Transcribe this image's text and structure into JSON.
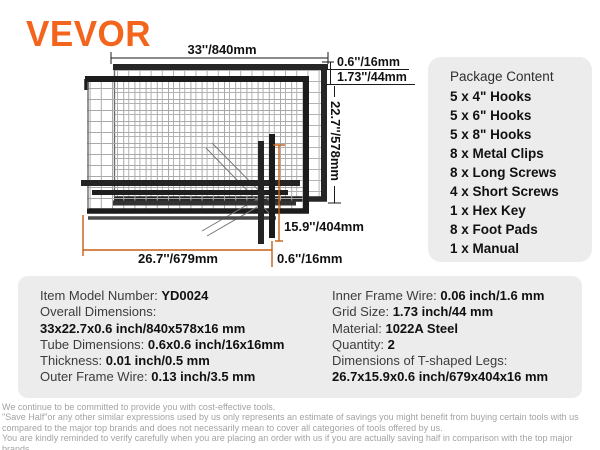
{
  "brand": {
    "name": "VEVOR"
  },
  "colors": {
    "brand_orange": "#F3641C",
    "dimension_orange": "#C85E15",
    "panel_background": "#ececec",
    "frame_black": "#1c1c1c"
  },
  "diagram": {
    "dims": {
      "overall_width": "33''/840mm",
      "frame_tube": "0.6''/16mm",
      "grid_size": "1.73''/44mm",
      "overall_height": "22.7''/578mm",
      "leg_height": "15.9''/404mm",
      "leg_length": "26.7''/679mm",
      "leg_tube": "0.6''/16mm"
    }
  },
  "package": {
    "title": "Package Content",
    "items": [
      "5 x 4\" Hooks",
      "5 x 6\" Hooks",
      "5 x 8\" Hooks",
      "8 x Metal Clips",
      "8 x Long Screws",
      "4 x Short Screws",
      "1 x Hex Key",
      "8 x Foot Pads",
      "1 x Manual"
    ]
  },
  "specs": {
    "left": [
      {
        "label": "Item Model Number: ",
        "value": "YD0024"
      },
      {
        "label": "Overall Dimensions:",
        "value": ""
      },
      {
        "label": "",
        "value": "33x22.7x0.6 inch/840x578x16 mm"
      },
      {
        "label": "Tube Dimensions: ",
        "value": "0.6x0.6 inch/16x16mm"
      },
      {
        "label": "Thickness: ",
        "value": "0.01 inch/0.5 mm"
      },
      {
        "label": "Outer Frame Wire: ",
        "value": "0.13 inch/3.5 mm"
      }
    ],
    "right": [
      {
        "label": "Inner Frame Wire: ",
        "value": "0.06 inch/1.6 mm"
      },
      {
        "label": "Grid Size: ",
        "value": "1.73 inch/44 mm"
      },
      {
        "label": "Material: ",
        "value": "1022A Steel"
      },
      {
        "label": "Quantity: ",
        "value": "2"
      },
      {
        "label": "Dimensions of T-shaped Legs:",
        "value": ""
      },
      {
        "label": "",
        "value": "26.7x15.9x0.6 inch/679x404x16 mm"
      }
    ]
  },
  "footer": {
    "lines": [
      "We continue to be committed to provide you with cost-effective tools.",
      "\"Save Half\"or any other similar expressions used by us only represents an estimate of savings you might benefit from buying certain tools with us compared to the major top brands and does not necessarily mean to cover all categories of tools offered by us.",
      "You are kindly reminded to verify carefully when you are placing an order with us if you are actually saving half in comparison with the top major brands."
    ]
  }
}
